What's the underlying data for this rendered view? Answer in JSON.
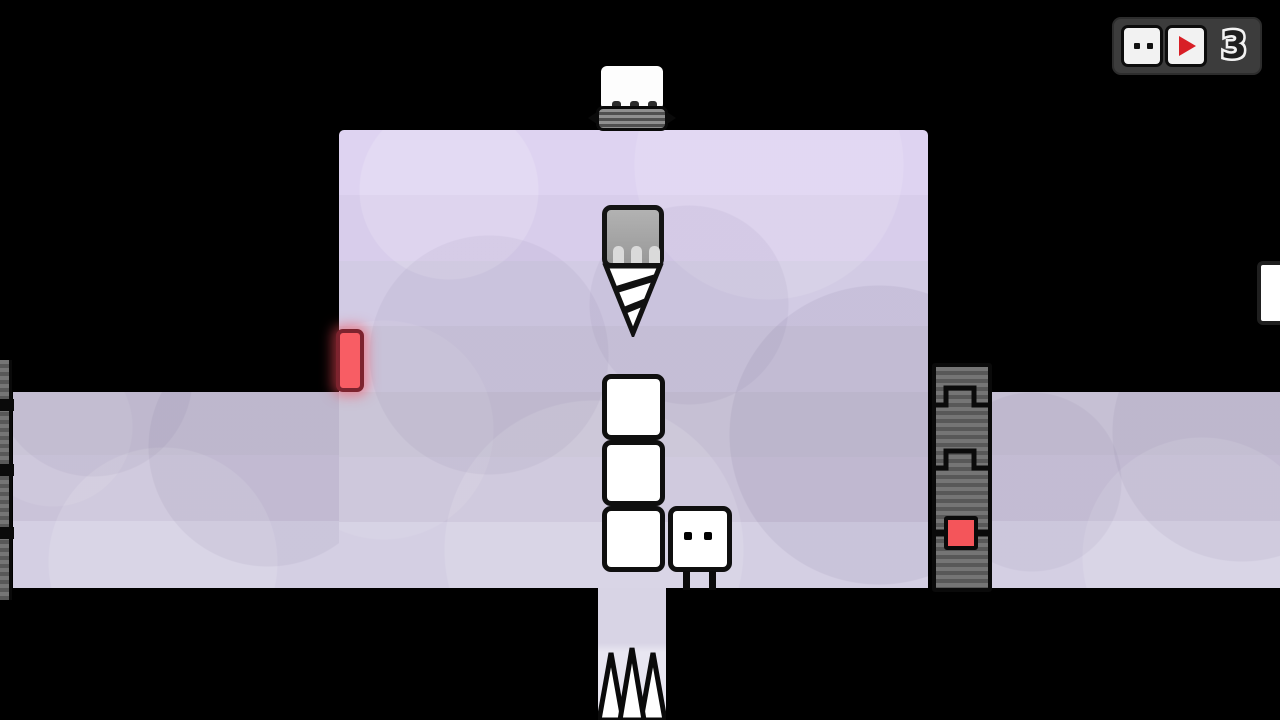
{
  "hud": {
    "count": "3",
    "icons": [
      {
        "name": "character-face-icon",
        "meaning": "boxes available indicator"
      },
      {
        "name": "play-triangle-icon",
        "meaning": "action indicator"
      }
    ]
  },
  "level": {
    "stacked_boxes": 3,
    "floor_spikes": 3,
    "objects": [
      "crusher",
      "drill",
      "red-door",
      "box-stack",
      "character",
      "track-column-right",
      "track-strip-left",
      "red-switch",
      "floor-spikes",
      "white-edge-box"
    ]
  },
  "colors": {
    "background": "#000000",
    "platform_top": "#ded3f1",
    "platform_mid": "#c6c0d4",
    "platform_bottom": "#d4cfe3",
    "door_red": "#f85d64",
    "switch_red": "#f4555a",
    "play_red": "#d81f26",
    "track_gray": "#757575",
    "hud_panel": "#3c3c3c",
    "drill_gray": "#a8a8a8"
  }
}
